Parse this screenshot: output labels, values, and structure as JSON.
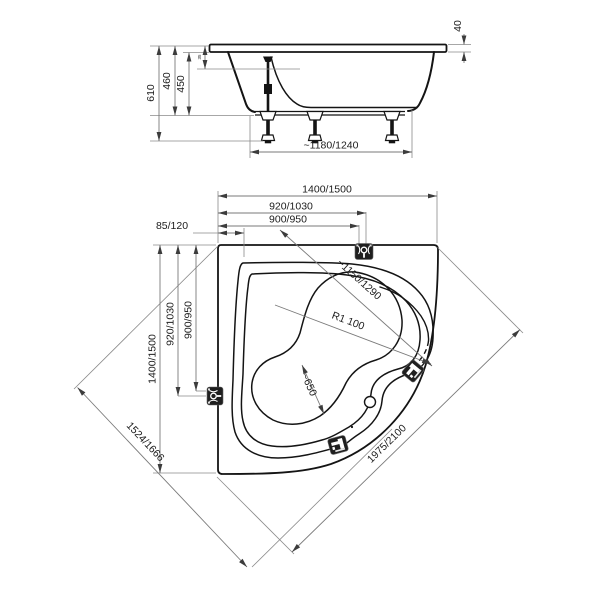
{
  "drawing": {
    "side_view": {
      "total_height": "610",
      "rim_height": "460",
      "inner_depth": "450",
      "rim_detail": "35",
      "apron_edge": "40",
      "base_length": "~1180/1240"
    },
    "plan_view": {
      "width_top": "1400/1500",
      "jet_offset_x": "920/1030",
      "drain_offset_x": "900/950",
      "corner_offset": "85/120",
      "height_left": "1400/1500",
      "jet_offset_y": "920/1030",
      "drain_offset_y": "900/950",
      "diag_back": "1524/1666",
      "front_edge": "1975/2100",
      "inner_diagonal": "~1150/1290",
      "inner_radius": "R1 100",
      "waist_width": "~650"
    },
    "icons": {
      "jet_top": "jet-symbol",
      "jet_left": "jet-symbol",
      "faucet_right": "faucet-symbol",
      "faucet_bottom": "faucet-symbol"
    }
  }
}
